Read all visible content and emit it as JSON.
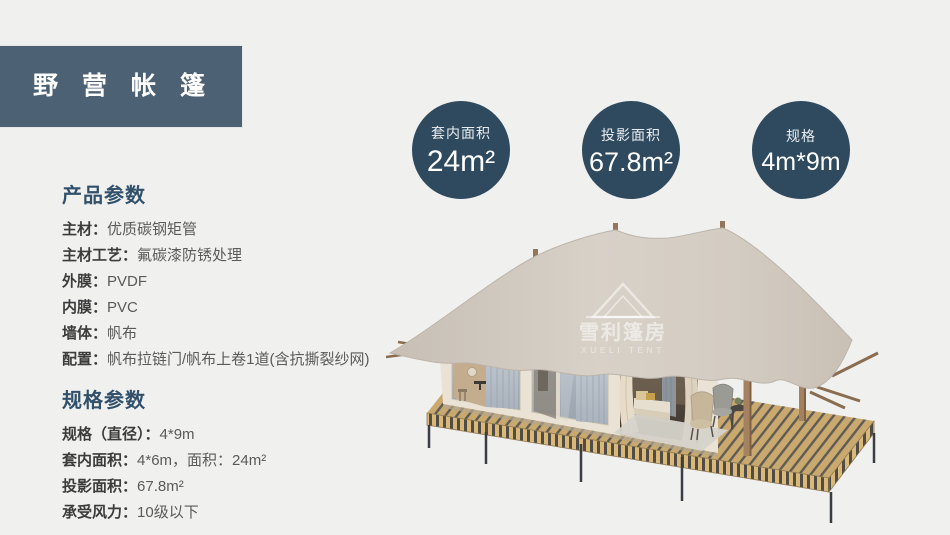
{
  "header": {
    "title": "野营帐篷"
  },
  "badges": {
    "items": [
      {
        "label": "套内面积",
        "value": "24m²"
      },
      {
        "label": "投影面积",
        "value": "67.8m²"
      },
      {
        "label": "规格",
        "value": "4m*9m"
      }
    ]
  },
  "product_params": {
    "title": "产品参数",
    "items": [
      {
        "label": "主材：",
        "value": "优质碳钢矩管"
      },
      {
        "label": "主材工艺：",
        "value": "氟碳漆防锈处理"
      },
      {
        "label": "外膜：",
        "value": "PVDF"
      },
      {
        "label": "内膜：",
        "value": "PVC"
      },
      {
        "label": "墙体：",
        "value": "帆布"
      },
      {
        "label": "配置：",
        "value": "帆布拉链门/帆布上卷1道(含抗撕裂纱网)"
      }
    ]
  },
  "spec_params": {
    "title": "规格参数",
    "items": [
      {
        "label": "规格（直径）：",
        "value": "4*9m"
      },
      {
        "label": "套内面积：",
        "value": "4*6m，面积：24m²"
      },
      {
        "label": "投影面积：",
        "value": "67.8m²"
      },
      {
        "label": "承受风力：",
        "value": "10级以下"
      }
    ]
  },
  "tent": {
    "watermark_cn": "雪利篷房",
    "watermark_en": "XUELI TENT"
  },
  "colors": {
    "page_bg": "#f0f0ef",
    "header_bg": "#4d6174",
    "badge_bg": "#2f4a5e",
    "heading": "#31506b",
    "canopy": "#d4ccc3",
    "deck_wood": "#c9a96e"
  }
}
